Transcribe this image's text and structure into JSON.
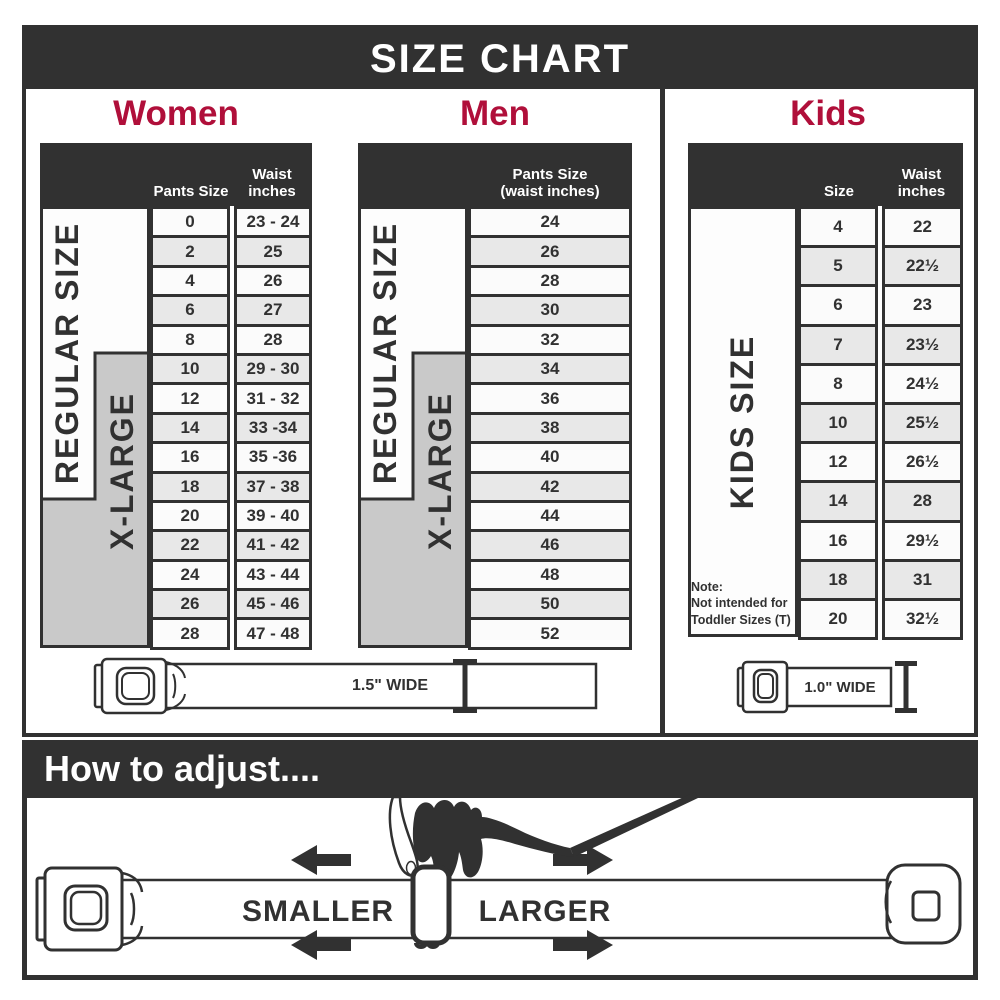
{
  "title": "SIZE CHART",
  "colors": {
    "dark": "#313131",
    "accent_red": "#b00f3a",
    "band_gray": "#c9c9c9",
    "row_shade": "#e8e8e8",
    "row_plain": "#fbfbfb"
  },
  "sections": {
    "women": {
      "heading": "Women",
      "size_header": "Pants Size",
      "waist_header": "Waist\ninches",
      "regular_label": "REGULAR SIZE",
      "xlarge_label": "X-LARGE"
    },
    "men": {
      "heading": "Men",
      "size_header": "Pants Size\n(waist inches)",
      "regular_label": "REGULAR SIZE",
      "xlarge_label": "X-LARGE"
    },
    "kids": {
      "heading": "Kids",
      "size_header": "Size",
      "waist_header": "Waist\ninches",
      "band_label": "KIDS SIZE",
      "note_lines": [
        "Note:",
        "Not intended for",
        "Toddler Sizes (T)"
      ]
    }
  },
  "belts": {
    "adult_width_label": "1.5\" WIDE",
    "kids_width_label": "1.0\" WIDE"
  },
  "how_to": {
    "heading": "How to adjust....",
    "smaller_label": "SMALLER",
    "larger_label": "LARGER"
  },
  "chart_data": [
    {
      "type": "table",
      "title": "Women",
      "columns": [
        "Pants Size",
        "Waist inches"
      ],
      "rows": [
        [
          "0",
          "23 - 24"
        ],
        [
          "2",
          "25"
        ],
        [
          "4",
          "26"
        ],
        [
          "6",
          "27"
        ],
        [
          "8",
          "28"
        ],
        [
          "10",
          "29 - 30"
        ],
        [
          "12",
          "31 - 32"
        ],
        [
          "14",
          "33 -34"
        ],
        [
          "16",
          "35 -36"
        ],
        [
          "18",
          "37 - 38"
        ],
        [
          "20",
          "39 - 40"
        ],
        [
          "22",
          "41 - 42"
        ],
        [
          "24",
          "43 - 44"
        ],
        [
          "26",
          "45 - 46"
        ],
        [
          "28",
          "47 - 48"
        ]
      ],
      "size_bands": [
        {
          "label": "REGULAR SIZE",
          "covers_rows": "0–18"
        },
        {
          "label": "X-LARGE",
          "covers_rows": "10–28"
        }
      ]
    },
    {
      "type": "table",
      "title": "Men",
      "columns": [
        "Pants Size (waist inches)"
      ],
      "rows": [
        [
          "24"
        ],
        [
          "26"
        ],
        [
          "28"
        ],
        [
          "30"
        ],
        [
          "32"
        ],
        [
          "34"
        ],
        [
          "36"
        ],
        [
          "38"
        ],
        [
          "40"
        ],
        [
          "42"
        ],
        [
          "44"
        ],
        [
          "46"
        ],
        [
          "48"
        ],
        [
          "50"
        ],
        [
          "52"
        ]
      ],
      "size_bands": [
        {
          "label": "REGULAR SIZE",
          "covers_rows": "24–42"
        },
        {
          "label": "X-LARGE",
          "covers_rows": "34–52"
        }
      ]
    },
    {
      "type": "table",
      "title": "Kids",
      "columns": [
        "Size",
        "Waist inches"
      ],
      "rows": [
        [
          "4",
          "22"
        ],
        [
          "5",
          "22½"
        ],
        [
          "6",
          "23"
        ],
        [
          "7",
          "23½"
        ],
        [
          "8",
          "24½"
        ],
        [
          "10",
          "25½"
        ],
        [
          "12",
          "26½"
        ],
        [
          "14",
          "28"
        ],
        [
          "16",
          "29½"
        ],
        [
          "18",
          "31"
        ],
        [
          "20",
          "32½"
        ]
      ],
      "size_bands": [
        {
          "label": "KIDS SIZE",
          "covers_rows": "4–20"
        }
      ],
      "note": "Note: Not intended for Toddler Sizes (T)"
    }
  ]
}
